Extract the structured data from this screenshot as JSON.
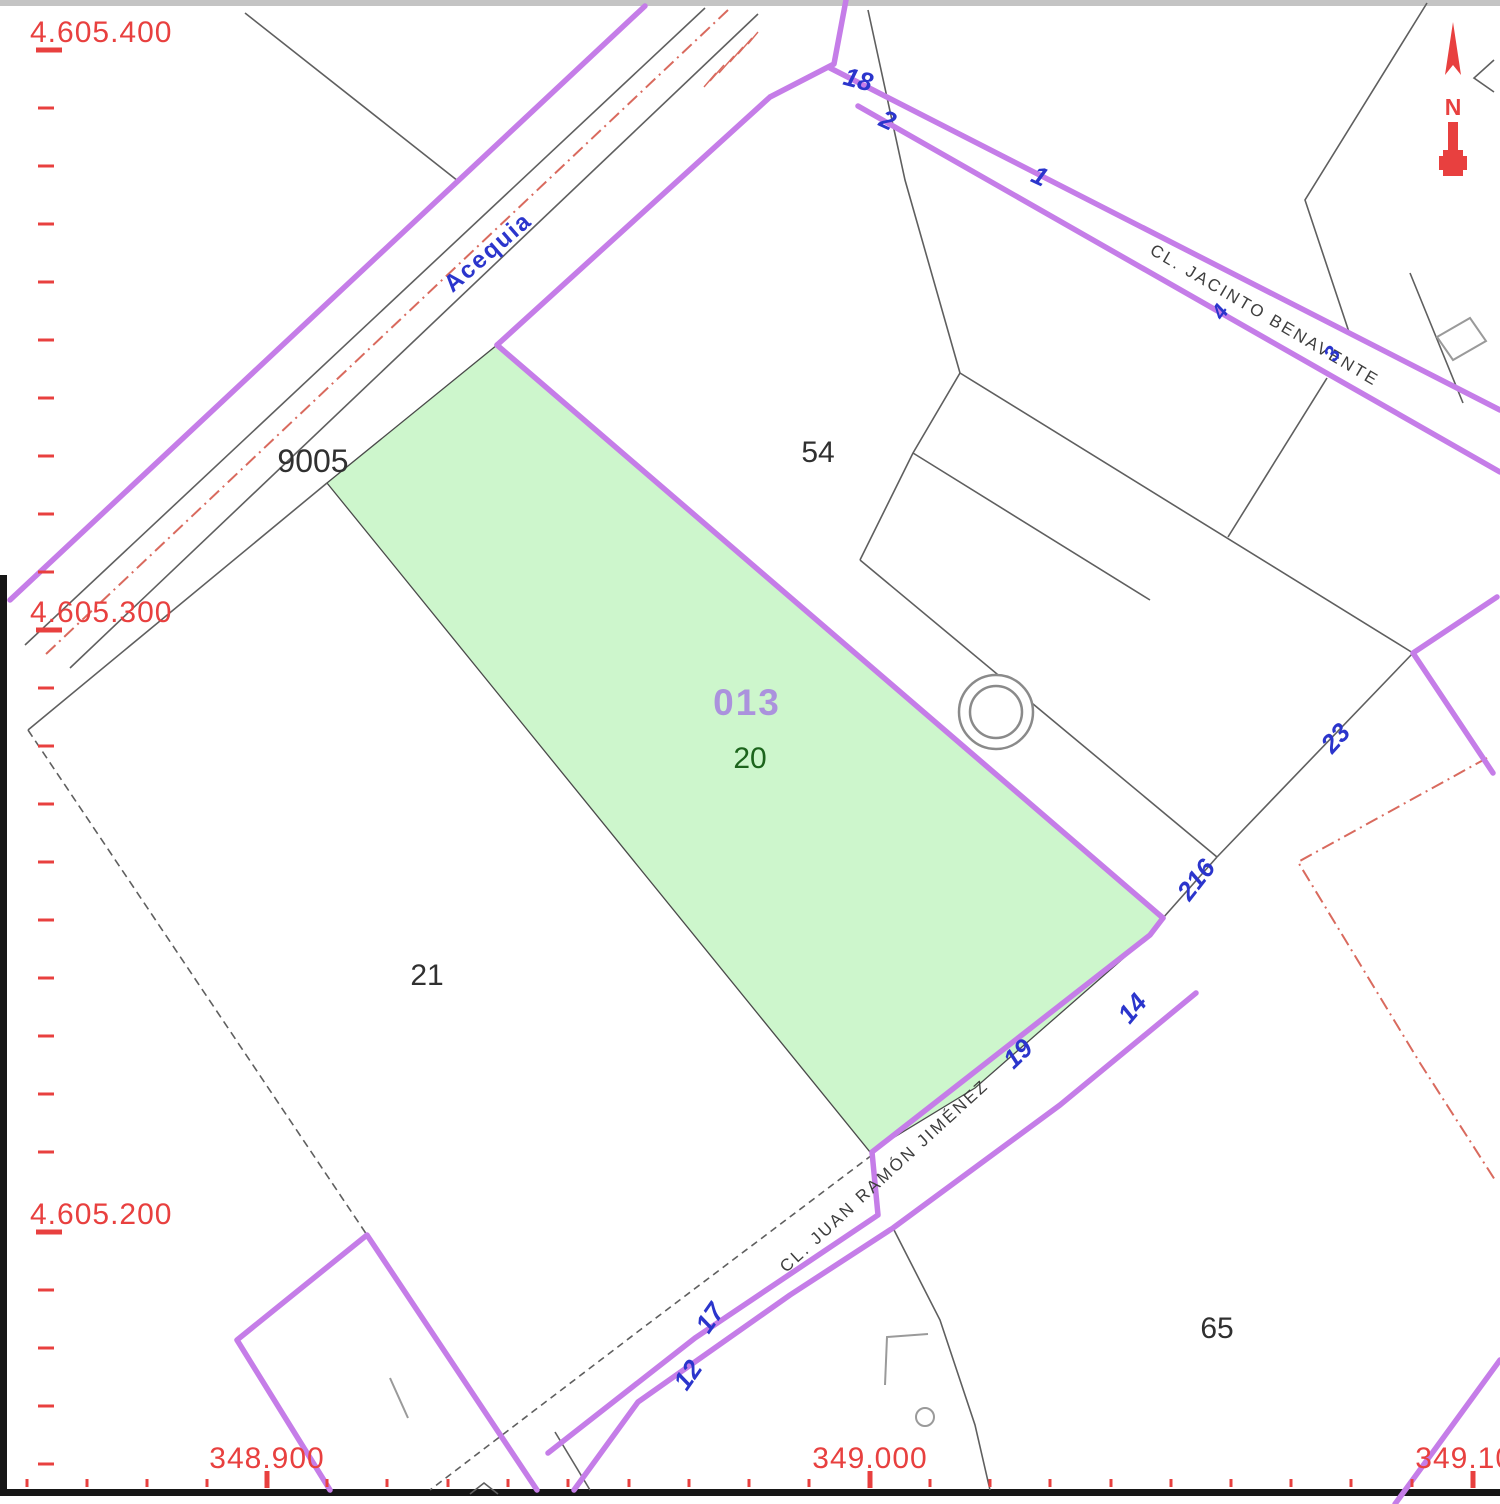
{
  "map": {
    "type": "cadastral-parcel-map",
    "colors": {
      "road_border_purple": "#c57de8",
      "highlight_parcel_fill": "#cdf6cc",
      "ruler_red": "#e8403f",
      "boundary_red_dashdot": "#d96a5e",
      "blue_label": "#2b35cc",
      "reference_violet": "#ab92dd",
      "parcel_number_green": "#1c641c",
      "boundary_gray": "#5f5f5f"
    },
    "north_arrow": {
      "letter": "N"
    }
  },
  "rulers": {
    "left": [
      {
        "label": "4.605.400"
      },
      {
        "label": "4.605.300"
      },
      {
        "label": "4.605.200"
      }
    ],
    "bottom": [
      {
        "label": "348.900"
      },
      {
        "label": "349.000"
      },
      {
        "label": "349.100"
      }
    ]
  },
  "streets": [
    {
      "name": "Acequia",
      "type": "waterway"
    },
    {
      "name": "CL. JACINTO BENAVENTE",
      "type": "street"
    },
    {
      "name": "CL. JUAN RAMÓN JIMÉNEZ",
      "type": "street"
    }
  ],
  "parcels": [
    {
      "label": "9005"
    },
    {
      "label": "54"
    },
    {
      "label": "21"
    },
    {
      "label": "65"
    },
    {
      "label": "20",
      "highlighted": true
    },
    {
      "label": "013",
      "kind": "cadastral-reference"
    }
  ],
  "house_numbers": [
    {
      "text": "18"
    },
    {
      "text": "2"
    },
    {
      "text": "1"
    },
    {
      "text": "4"
    },
    {
      "text": "3"
    },
    {
      "text": "23"
    },
    {
      "text": "216"
    },
    {
      "text": "14"
    },
    {
      "text": "19"
    },
    {
      "text": "17"
    },
    {
      "text": "12"
    }
  ]
}
